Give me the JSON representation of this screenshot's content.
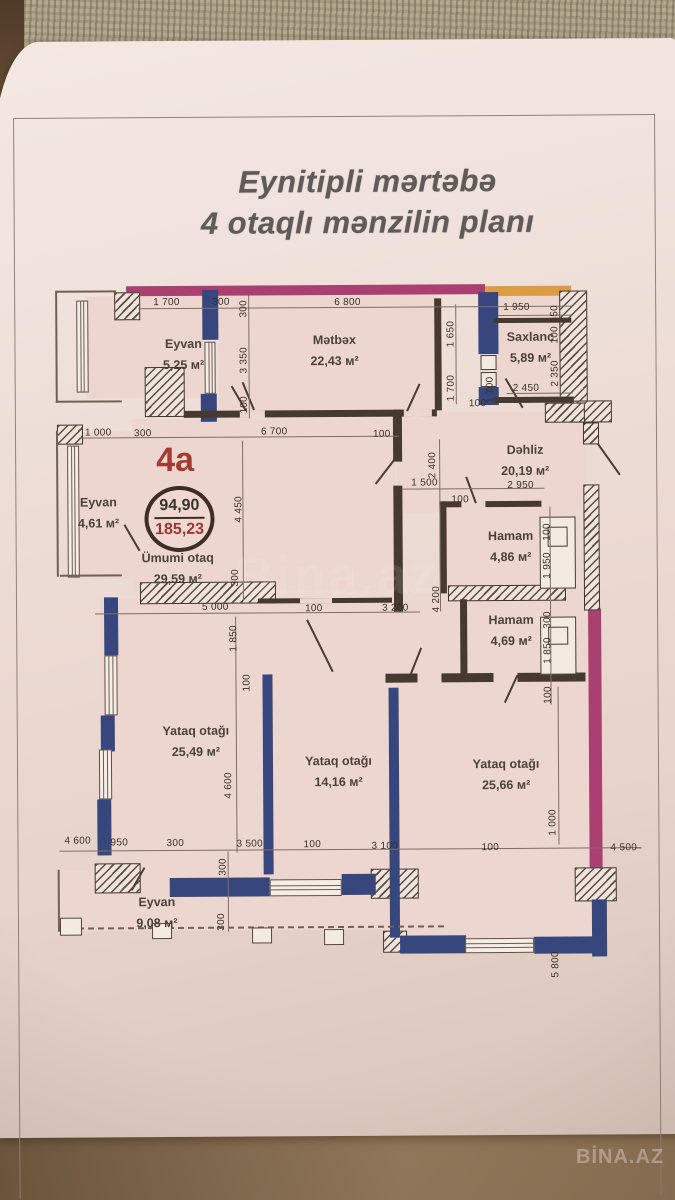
{
  "photo": {
    "watermark_corner": "BİNA.AZ",
    "watermark_center": "Bina.az"
  },
  "page": {
    "title_line1": "Eynitipli mərtəbə",
    "title_line2": "4 otaqlı mənzilin planı"
  },
  "plan": {
    "unit": {
      "label": "4a",
      "area_top": "94,90",
      "area_bottom": "185,23"
    },
    "rooms": [
      {
        "name": "Eyvan",
        "area": "5,25 м²"
      },
      {
        "name": "Mətbəx",
        "area": "22,43 м²"
      },
      {
        "name": "Saxlanc",
        "area": "5,89 м²"
      },
      {
        "name": "Dəhliz",
        "area": "20,19 м²"
      },
      {
        "name": "Hamam",
        "area": "4,86 м²"
      },
      {
        "name": "Hamam",
        "area": "4,69 м²"
      },
      {
        "name": "Ümumi otaq",
        "area": "29,59 м²"
      },
      {
        "name": "Eyvan",
        "area": "4,61 м²"
      },
      {
        "name": "Yataq otağı",
        "area": "25,49 м²"
      },
      {
        "name": "Yataq otağı",
        "area": "14,16 м²"
      },
      {
        "name": "Yataq otağı",
        "area": "25,66 м²"
      },
      {
        "name": "Eyvan",
        "area": "9,08 м²"
      }
    ],
    "dims": [
      "1 700",
      "300",
      "6 800",
      "1 950",
      "650",
      "300",
      "3 350",
      "100",
      "1 650",
      "1 700",
      "1 700",
      "100",
      "100",
      "2 350",
      "2 450",
      "1 000",
      "300",
      "6 700",
      "100",
      "4 450",
      "300",
      "2 400",
      "1 500",
      "100",
      "2 950",
      "100",
      "1 950",
      "300",
      "1 850",
      "100",
      "4 200",
      "3 200",
      "5 000",
      "100",
      "1 850",
      "100",
      "4 600",
      "950",
      "300",
      "3 500",
      "100",
      "3 100",
      "100",
      "4 500",
      "300",
      "300",
      "1 000",
      "5 800",
      "300"
    ]
  },
  "colors": {
    "wall_navy": "#37477e",
    "wall_magenta": "#aa3f72",
    "wall_orange": "#db9c44",
    "wall_dark": "#463a30",
    "unit_red": "#a23c33",
    "paper": "#eddcd6"
  }
}
